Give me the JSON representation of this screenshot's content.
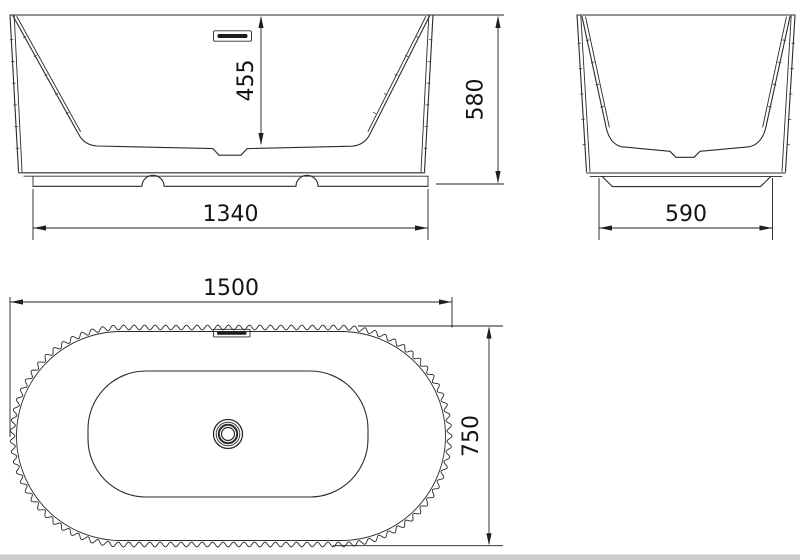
{
  "colors": {
    "line": "#2b2b2b",
    "dimension": "#1f1f1f",
    "text": "#141414",
    "background": "#ffffff",
    "bottom_strip": "#cccccc"
  },
  "views": {
    "front": {
      "dim_inner_depth": "455",
      "dim_overall_height": "580",
      "dim_base_width": "1340"
    },
    "side": {
      "dim_base_width": "590"
    },
    "plan": {
      "dim_overall_length": "1500",
      "dim_overall_width": "750"
    }
  }
}
